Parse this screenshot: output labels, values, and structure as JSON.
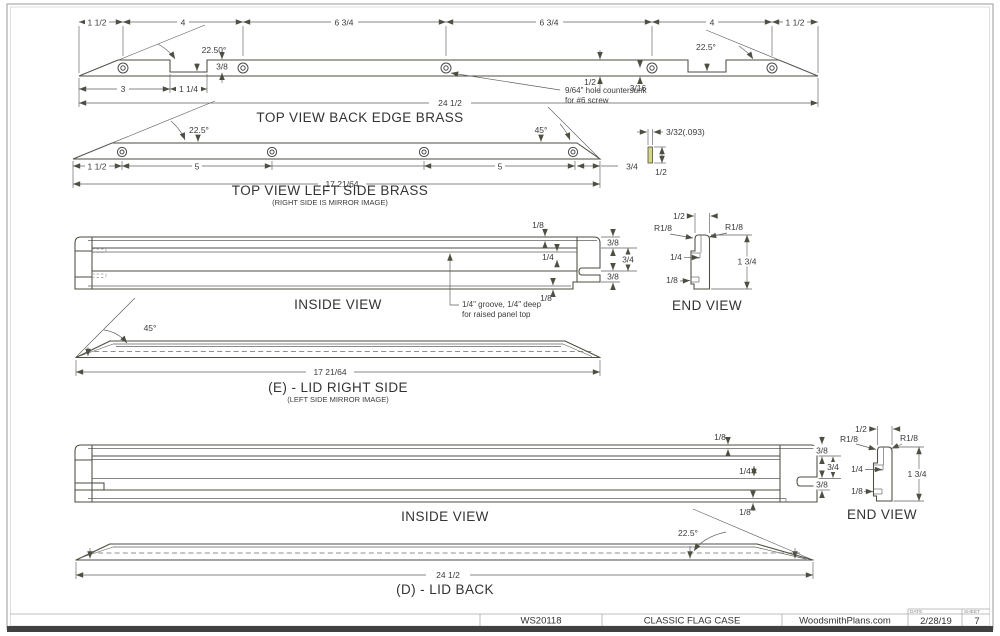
{
  "colors": {
    "brass_light": "#f2f1a3",
    "brass_dark": "#c8cb86",
    "line": "#4e4e42"
  },
  "title_block": {
    "code": "WS20118",
    "project": "CLASSIC FLAG CASE",
    "site": "WoodsmithPlans.com",
    "date_label": "DATE",
    "date": "2/28/19",
    "sheet_label": "SHEET",
    "sheet_number": "7"
  },
  "top_back": {
    "title": "TOP VIEW BACK EDGE BRASS",
    "angle_left": "22.50°",
    "angle_right": "22.5°",
    "seg1": "1 1/2",
    "seg2": "4",
    "seg3": "6 3/4",
    "seg4": "6 3/4",
    "seg5": "4",
    "seg6": "1 1/2",
    "tip_to_notch": "3",
    "notch_width": "1 1/4",
    "notch_depth": "3/8",
    "strip_width": "1/2",
    "hole_offset": "3/16",
    "overall": "24 1/2",
    "note1": "9/64\" hole countersunk",
    "note2": "for #6 screw"
  },
  "top_left": {
    "title": "TOP VIEW LEFT SIDE BRASS",
    "subtitle": "(RIGHT SIDE IS MIRROR IMAGE)",
    "angle_left": "22.5°",
    "angle_right": "45°",
    "seg1": "1 1/2",
    "seg2": "5",
    "seg3": "5",
    "seg4": "3/4",
    "overall": "17 21/64"
  },
  "strip_section": {
    "thickness": "3/32(.093)",
    "width": "1/2"
  },
  "inside_top": {
    "title": "INSIDE VIEW",
    "lip_top": "1/8",
    "rail_top": "3/8",
    "groove": "1/4",
    "middle": "3/4",
    "rail_bottom": "3/8",
    "lip_bottom": "1/8",
    "note1": "1/4\" groove, 1/4\" deep",
    "note2": "for raised panel top"
  },
  "end_top": {
    "title": "END VIEW",
    "width": "1/2",
    "radius_left": "R1/8",
    "radius_right": "R1/8",
    "groove": "1/4",
    "height": "1 3/4",
    "notch": "1/8"
  },
  "lid_right": {
    "title": "(E) - LID RIGHT SIDE",
    "subtitle": "(LEFT SIDE MIRROR IMAGE)",
    "angle": "45°",
    "overall": "17 21/64"
  },
  "inside_bottom": {
    "title": "INSIDE VIEW",
    "lip_top": "1/8",
    "rail_top": "3/8",
    "groove": "1/4",
    "middle": "3/4",
    "rail_bottom": "3/8",
    "lip_bottom": "1/8"
  },
  "end_bottom": {
    "title": "END VIEW",
    "width": "1/2",
    "radius_left": "R1/8",
    "radius_right": "R1/8",
    "groove": "1/4",
    "height": "1 3/4",
    "notch": "1/8"
  },
  "lid_back": {
    "title": "(D) - LID BACK",
    "angle": "22.5°",
    "overall": "24 1/2"
  }
}
